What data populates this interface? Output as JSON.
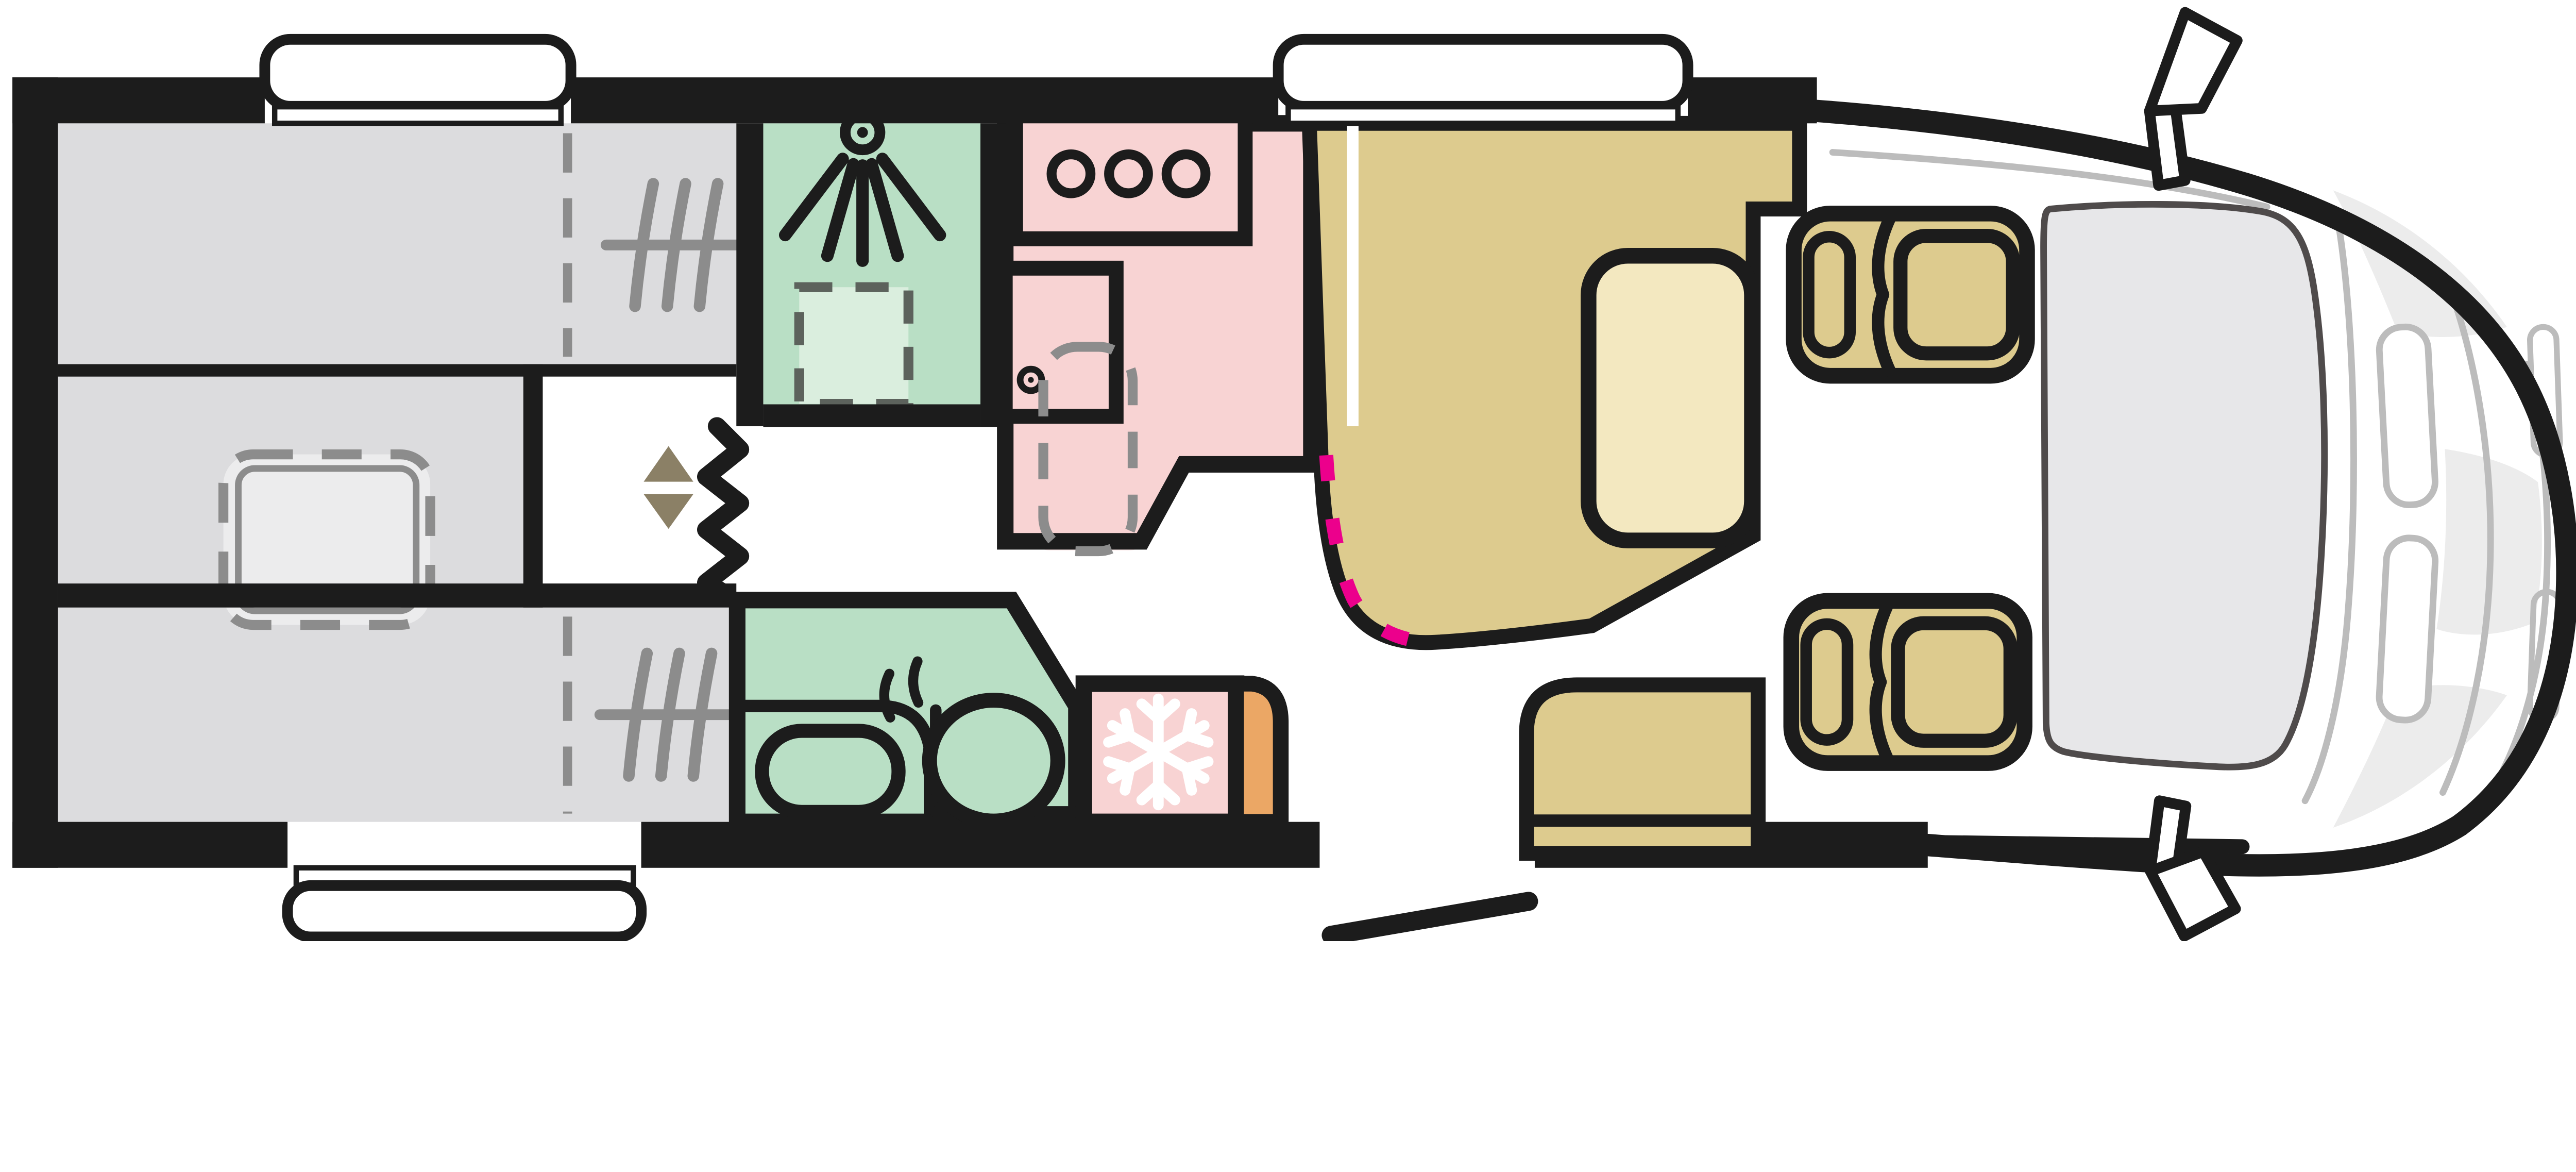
{
  "diagram": {
    "kind": "motorhome-floorplan-top-view",
    "front_of_vehicle": "right",
    "rear_of_vehicle": "left",
    "visible_text": ""
  },
  "colors": {
    "line": "#1c1c1c",
    "floor": "#ffffff",
    "window_white": "#ffffff",
    "bed_gray": "#dcdcde",
    "bed_light": "#ededee",
    "green": "#b9dfc5",
    "green_light": "#daeede",
    "tray_edge": "#5c625c",
    "pink": "#f8d3d3",
    "pink_light": "#fbe5e5",
    "tan": "#ddcb8e",
    "tan_light": "#f3e8c0",
    "orange": "#eba765",
    "magenta": "#ec008c",
    "glass": "#e7e7e9",
    "glass_edge": "#4f4b4b",
    "detail_gray": "#bcbcbc",
    "patch_gray": "#ececec",
    "icon_gray": "#8c8c8c",
    "triangle_brown": "#8b8066"
  },
  "layout": {
    "rooms": [
      {
        "name": "rear-bed-upper",
        "color_ref": "bed_gray",
        "features": [
          "mattress-slats-icon",
          "fold-line-dashed"
        ]
      },
      {
        "name": "rear-bed-lower",
        "color_ref": "bed_gray",
        "features": [
          "mattress-slats-icon",
          "fold-line-dashed"
        ]
      },
      {
        "name": "rear-center-step",
        "color_ref": "bed_gray"
      },
      {
        "name": "drop-down-bed",
        "style": "dashed-outline",
        "color_ref": "bed_light"
      },
      {
        "name": "shower-room",
        "color_ref": "green",
        "features": [
          "shower-head-icon",
          "shower-tray-dashed"
        ]
      },
      {
        "name": "kitchen",
        "color_ref": "pink",
        "features": [
          "hob",
          "sink",
          "faucet"
        ],
        "burner_count": 3
      },
      {
        "name": "table",
        "style": "dashed-outline"
      },
      {
        "name": "bathroom",
        "color_ref": "green",
        "features": [
          "toilet",
          "washbasin",
          "vanity-counter"
        ]
      },
      {
        "name": "fridge",
        "color_ref": "pink",
        "features": [
          "snowflake-icon"
        ]
      },
      {
        "name": "wardrobe",
        "color_ref": "orange"
      },
      {
        "name": "dinette-bench",
        "color_ref": "tan",
        "features": [
          "seat-cushion",
          "seatbelt-marks-magenta"
        ]
      },
      {
        "name": "entry-bench",
        "color_ref": "tan"
      },
      {
        "name": "cab-seat-upper",
        "color_ref": "tan",
        "state": "swiveled-to-face-rear"
      },
      {
        "name": "cab-seat-lower",
        "color_ref": "tan",
        "state": "swiveled-to-face-rear"
      },
      {
        "name": "cab-front",
        "features": [
          "windshield",
          "mirror-upper",
          "mirror-lower",
          "headlights",
          "hood-contours"
        ]
      }
    ],
    "openings": {
      "window_count": 3,
      "entry_door": {
        "position": "bottom-center",
        "state": "open-leaf-shown"
      }
    },
    "dividers": [
      {
        "name": "concertina-partition",
        "icon": "zigzag-line"
      },
      {
        "name": "bed-lift-arrows",
        "icon": "up-down-triangles"
      }
    ]
  }
}
